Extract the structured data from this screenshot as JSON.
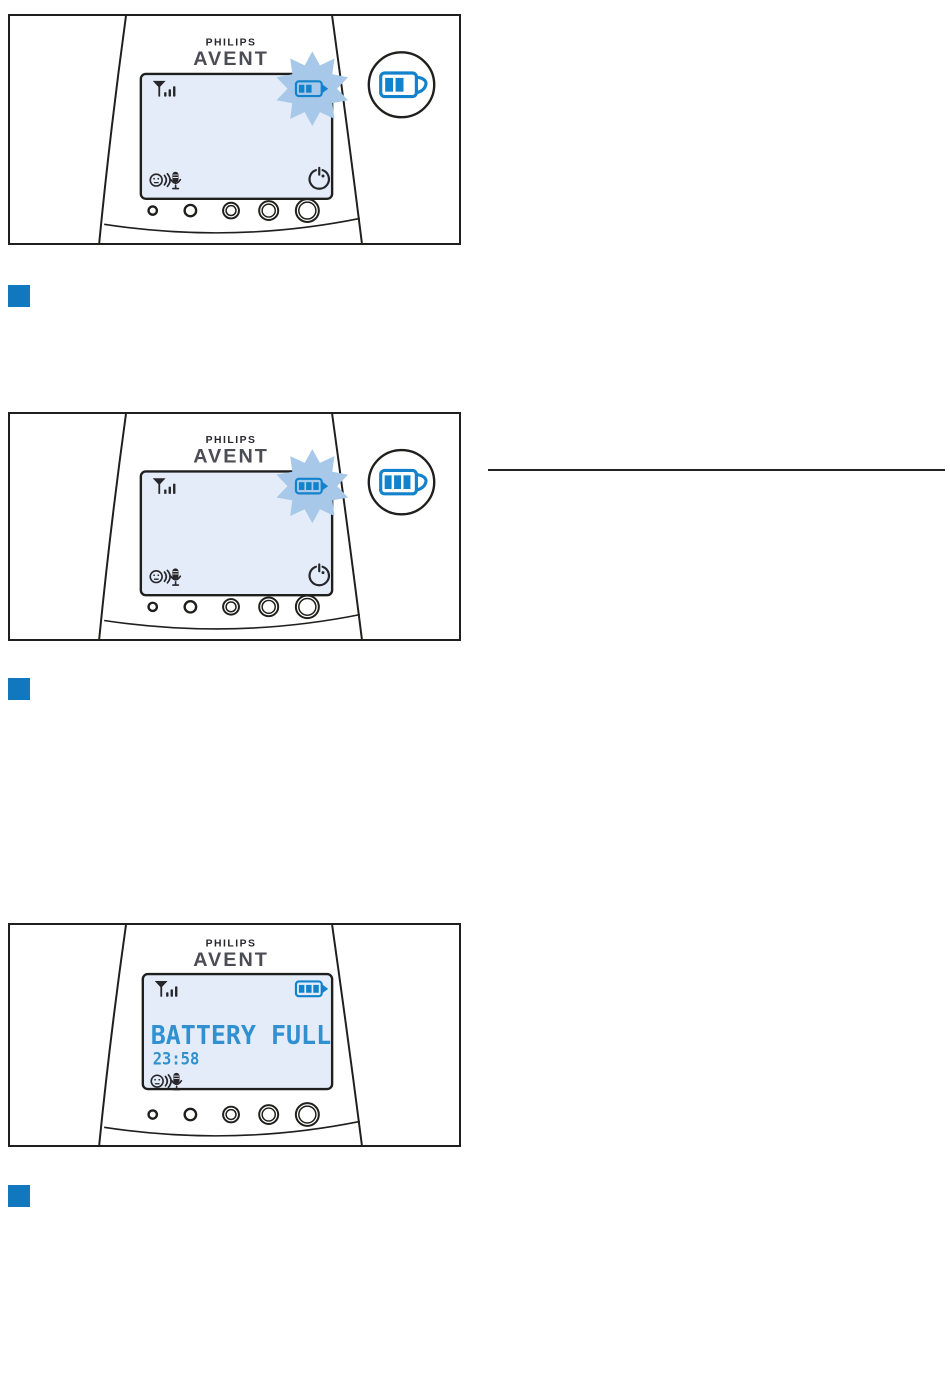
{
  "colors": {
    "step_bullet": "#1178bf",
    "battery_blue": "#1282cc",
    "burst_blue": "#a7c8e8",
    "screen_bg": "#e3ecf8",
    "lcd_text": "#3090d0",
    "outline": "#1f1f1d"
  },
  "divider": {
    "visible": true
  },
  "steps": [
    {
      "marker": "blue-square"
    },
    {
      "marker": "blue-square"
    },
    {
      "marker": "blue-square"
    }
  ],
  "figures": [
    {
      "brand_philips": "PHILIPS",
      "brand_avent": "AVENT",
      "display": {
        "signal_icon": "signal-strength",
        "battery_icon": {
          "segments": 2,
          "highlighted_burst": true
        },
        "talk_icon": "smiley-voice-microphone",
        "power_icon": "power-clock"
      },
      "badge": {
        "visible": true,
        "icon": "charging-battery",
        "segments": 2
      },
      "buttons_count": 5
    },
    {
      "brand_philips": "PHILIPS",
      "brand_avent": "AVENT",
      "display": {
        "signal_icon": "signal-strength",
        "battery_icon": {
          "segments": 3,
          "highlighted_burst": true
        },
        "talk_icon": "smiley-voice-microphone",
        "power_icon": "power-clock"
      },
      "badge": {
        "visible": true,
        "icon": "charging-battery",
        "segments": 3
      },
      "buttons_count": 5
    },
    {
      "brand_philips": "PHILIPS",
      "brand_avent": "AVENT",
      "display": {
        "signal_icon": "signal-strength",
        "battery_icon": {
          "segments": 3,
          "highlighted_burst": false
        },
        "talk_icon": "smiley-voice-microphone",
        "message": "BATTERY FULL",
        "time": "23:58"
      },
      "badge": {
        "visible": false
      },
      "buttons_count": 5
    }
  ]
}
